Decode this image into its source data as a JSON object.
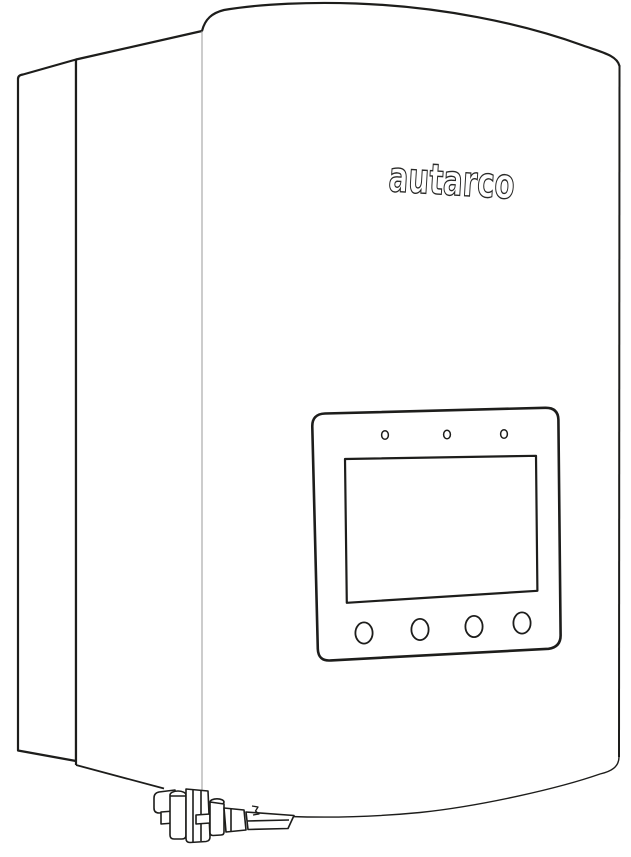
{
  "illustration": {
    "description": "Line drawing of a wall-mounted Autarco solar inverter, three-quarter view",
    "brand_logo_text": "autarco",
    "colors": {
      "line": "#1d1d1b",
      "light_edge": "#9a9a9a",
      "background": "#ffffff"
    },
    "display_panel": {
      "status_led_count": 3,
      "control_button_count": 4,
      "screen_content": ""
    },
    "connectors": {
      "location": "bottom-left underside",
      "cable_gland_count": 4
    }
  }
}
